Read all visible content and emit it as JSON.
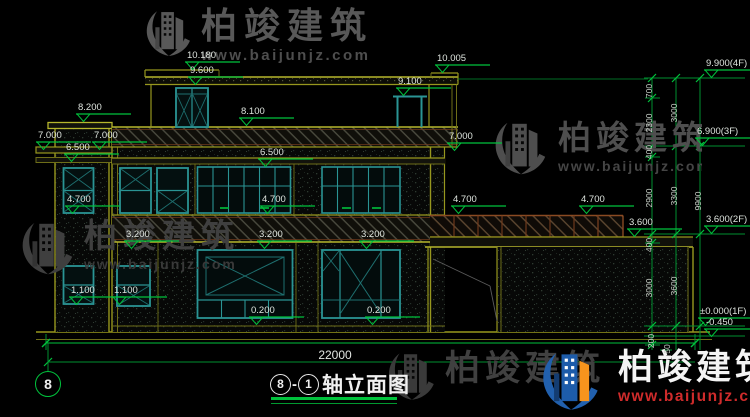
{
  "watermark": {
    "brand": "柏竣建筑",
    "url": "www.baijunjz.com"
  },
  "title": {
    "circle_left": "8",
    "dash": "-",
    "circle_right": "1",
    "name": "轴立面图",
    "axis_bubble": "8"
  },
  "dims": {
    "overall_width": "22000"
  },
  "drawing": {
    "elevation_markers": [
      {
        "label": "10.180",
        "ax": 193,
        "ay": 70
      },
      {
        "label": "9.600",
        "ax": 196,
        "ay": 85
      },
      {
        "label": "10.005",
        "ax": 443,
        "ay": 73
      },
      {
        "label": "9.100",
        "ax": 404,
        "ay": 96
      },
      {
        "label": "8.200",
        "ax": 84,
        "ay": 122
      },
      {
        "label": "8.100",
        "ax": 247,
        "ay": 126
      },
      {
        "label": "7.000",
        "ax": 44,
        "ay": 150
      },
      {
        "label": "7.000",
        "ax": 100,
        "ay": 150
      },
      {
        "label": "6.500",
        "ax": 72,
        "ay": 162
      },
      {
        "label": "6.500",
        "ax": 266,
        "ay": 167
      },
      {
        "label": "7.000",
        "ax": 455,
        "ay": 151
      },
      {
        "label": "4.700",
        "ax": 73,
        "ay": 214
      },
      {
        "label": "4.700",
        "ax": 268,
        "ay": 214
      },
      {
        "label": "4.700",
        "ax": 459,
        "ay": 214
      },
      {
        "label": "4.700",
        "ax": 587,
        "ay": 214
      },
      {
        "label": "3.200",
        "ax": 132,
        "ay": 249
      },
      {
        "label": "3.200",
        "ax": 265,
        "ay": 249
      },
      {
        "label": "3.200",
        "ax": 367,
        "ay": 249
      },
      {
        "label": "3.600",
        "ax": 635,
        "ay": 237
      },
      {
        "label": "1.100",
        "ax": 77,
        "ay": 305
      },
      {
        "label": "1.100",
        "ax": 120,
        "ay": 305
      },
      {
        "label": "0.200",
        "ax": 257,
        "ay": 325
      },
      {
        "label": "0.200",
        "ax": 373,
        "ay": 325
      },
      {
        "label": "9.900(4F)",
        "ax": 712,
        "ay": 78
      },
      {
        "label": "6.900(3F)",
        "ax": 703,
        "ay": 146
      },
      {
        "label": "3.600(2F)",
        "ax": 712,
        "ay": 234
      },
      {
        "label": "±0.000(1F)",
        "ax": 706,
        "ay": 326
      },
      {
        "label": "-0.450",
        "ax": 712,
        "ay": 337
      }
    ],
    "vertical_dims": [
      {
        "label": "700",
        "x": 649,
        "y": 91
      },
      {
        "label": "2300",
        "x": 649,
        "y": 123
      },
      {
        "label": "3000",
        "x": 674,
        "y": 113
      },
      {
        "label": "400",
        "x": 649,
        "y": 152
      },
      {
        "label": "2900",
        "x": 649,
        "y": 198
      },
      {
        "label": "3300",
        "x": 674,
        "y": 196
      },
      {
        "label": "9900",
        "x": 698,
        "y": 201
      },
      {
        "label": "400",
        "x": 649,
        "y": 245
      },
      {
        "label": "3000",
        "x": 649,
        "y": 288
      },
      {
        "label": "3600",
        "x": 674,
        "y": 286
      },
      {
        "label": "200",
        "x": 651,
        "y": 341
      },
      {
        "label": "50",
        "x": 667,
        "y": 349
      }
    ]
  }
}
